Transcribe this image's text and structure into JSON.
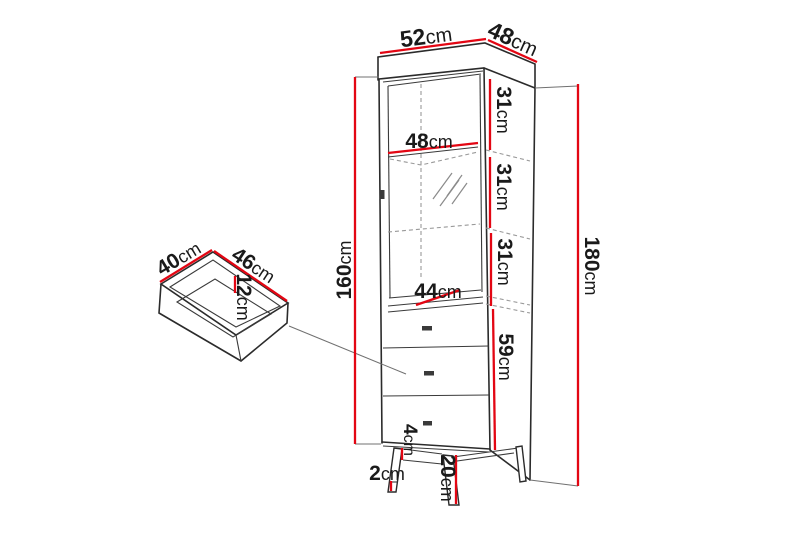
{
  "diagram": {
    "name": "display-cabinet-dimension-diagram",
    "unit": "cm"
  },
  "colors": {
    "dimension_red": "#e30613",
    "outline_dark": "#2b2b2b",
    "dashed_gray": "#999999",
    "witness_gray": "#707070",
    "text_dark": "#1a1a1a",
    "background": "#ffffff"
  },
  "dims": {
    "top_width": {
      "num": "52",
      "unit": "cm"
    },
    "top_depth": {
      "num": "48",
      "unit": "cm"
    },
    "interior_width": {
      "num": "48",
      "unit": "cm"
    },
    "section_top": {
      "num": "31",
      "unit": "cm"
    },
    "section_mid": {
      "num": "31",
      "unit": "cm"
    },
    "section_bottom": {
      "num": "31",
      "unit": "cm"
    },
    "front_height": {
      "num": "160",
      "unit": "cm"
    },
    "total_height": {
      "num": "180",
      "unit": "cm"
    },
    "drawer_section_height": {
      "num": "59",
      "unit": "cm"
    },
    "interior_width_base": {
      "num": "44",
      "unit": "cm"
    },
    "plinth_height": {
      "num": "4",
      "unit": "cm"
    },
    "foot_height": {
      "num": "2",
      "unit": "cm"
    },
    "leg_height": {
      "num": "20",
      "unit": "cm"
    },
    "drawer_inner_width": {
      "num": "40",
      "unit": "cm"
    },
    "drawer_inner_depth": {
      "num": "46",
      "unit": "cm"
    },
    "drawer_inner_height": {
      "num": "12",
      "unit": "cm"
    }
  }
}
